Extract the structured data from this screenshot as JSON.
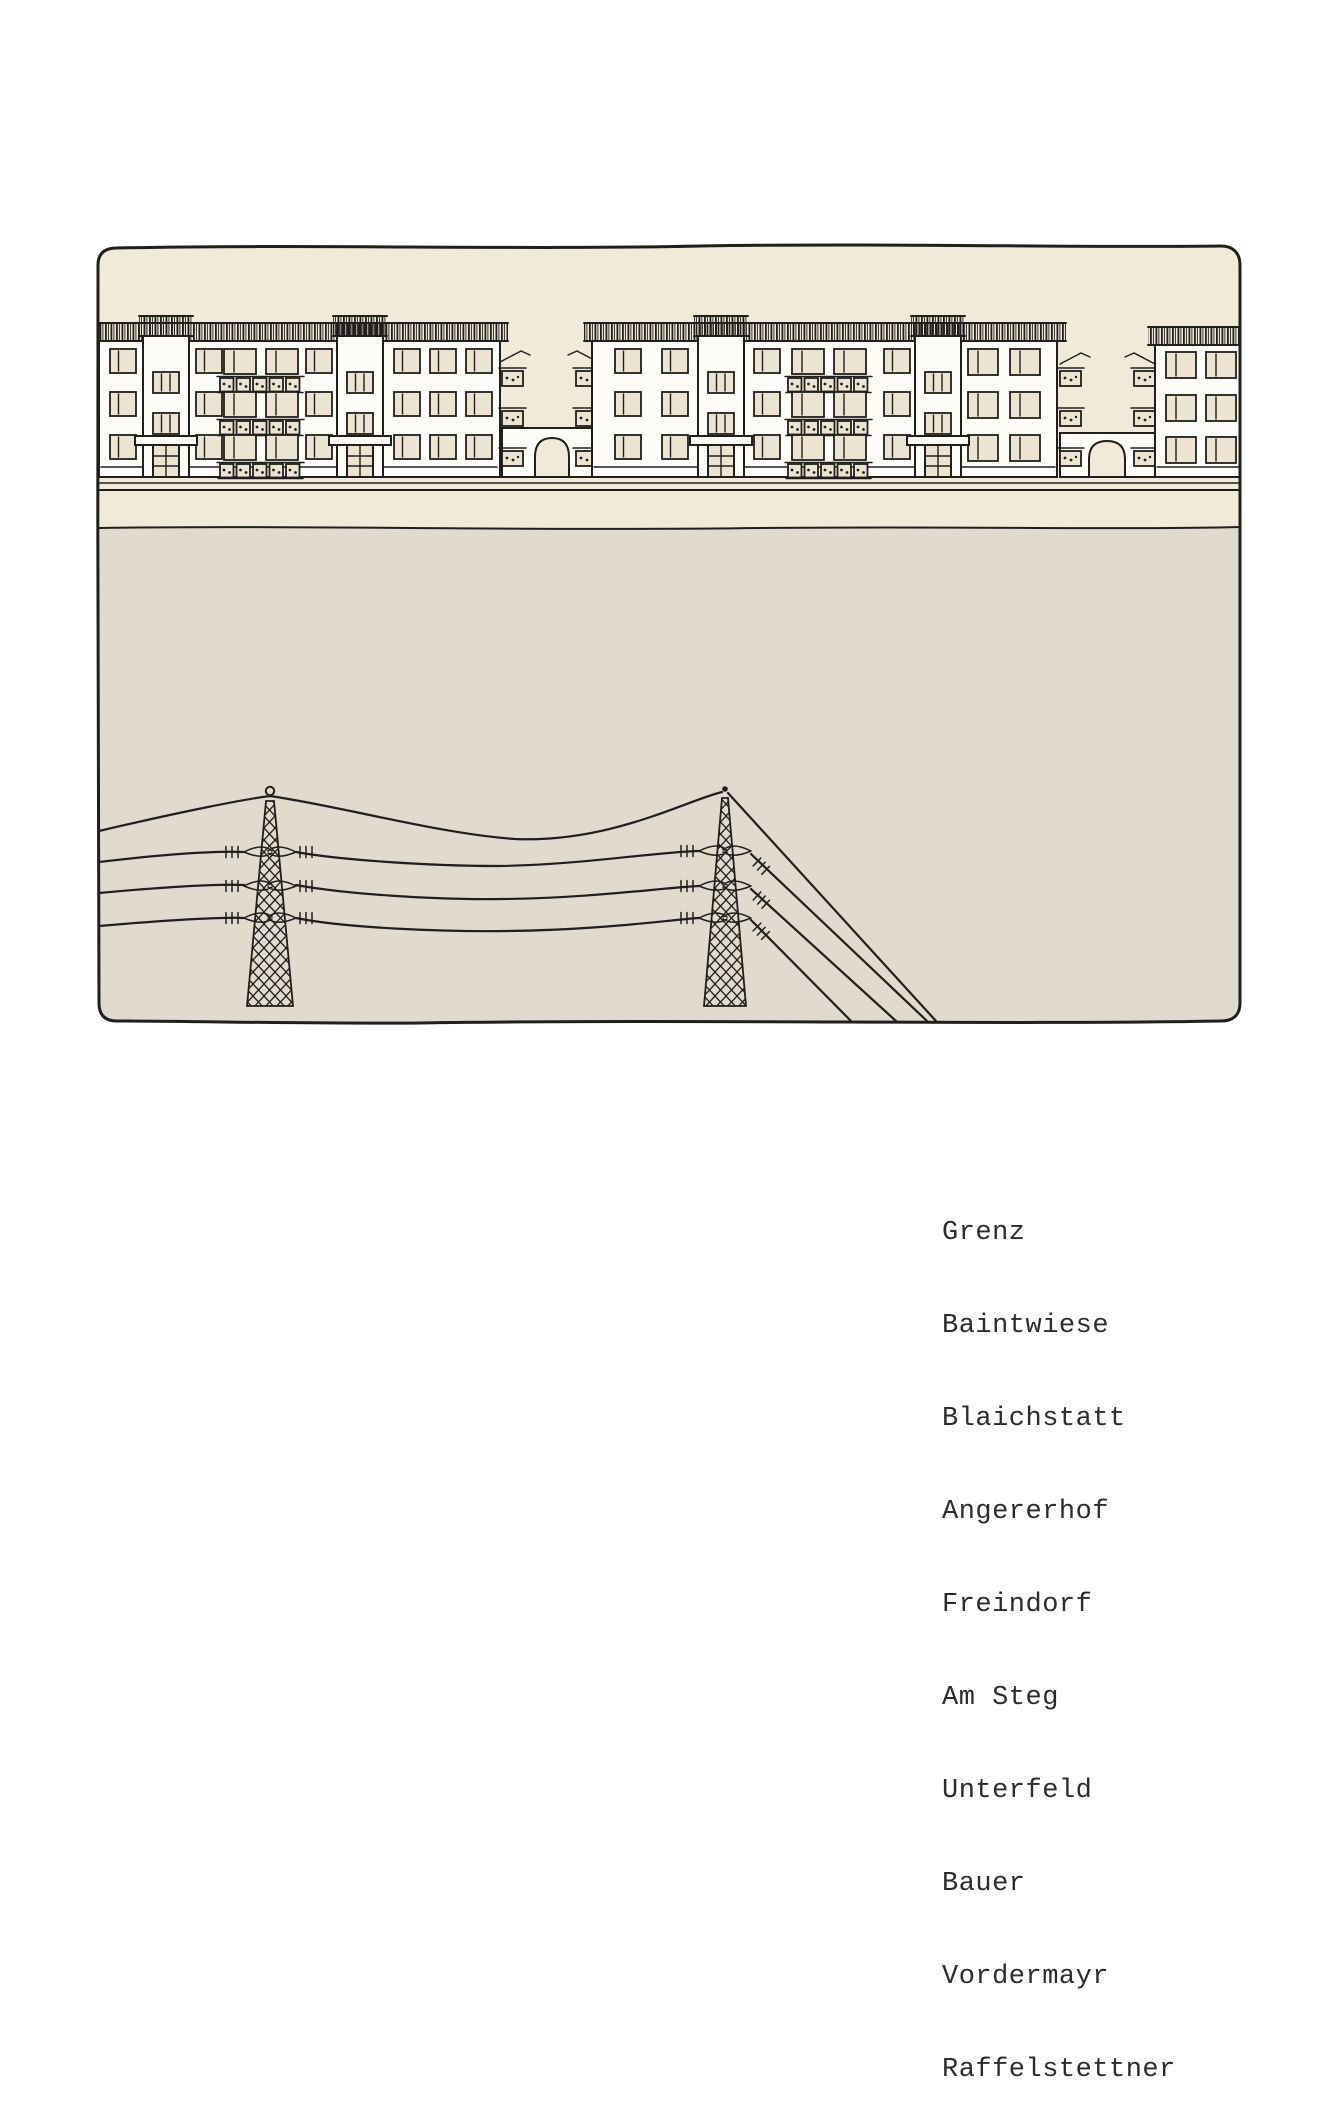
{
  "caption": {
    "names": [
      "Grenz",
      "Baintwiese",
      "Blaichstatt",
      "Angererhof",
      "Freindorf",
      "Am Steg",
      "Unterfeld",
      "Bauer",
      "Vordermayr",
      "Raffelstettner"
    ]
  },
  "illustration": {
    "alt": "Hand-drawn ink sketch: a row of three-storey apartment blocks with hatched roofs, balconies and archway passages, above a wide empty field crossed by four power lines carried on two lattice pylons",
    "buildings_count": 4,
    "archways_count": 2,
    "pylons_count": 2,
    "wires_count": 4,
    "storeys": 3
  },
  "colors": {
    "page": "#ffffff",
    "sky": "#f1ead9",
    "field": "#e0dbce",
    "facade": "#fdfcf8",
    "window": "#ece4d0",
    "ink": "#211f1c",
    "text": "#2e2c29"
  }
}
